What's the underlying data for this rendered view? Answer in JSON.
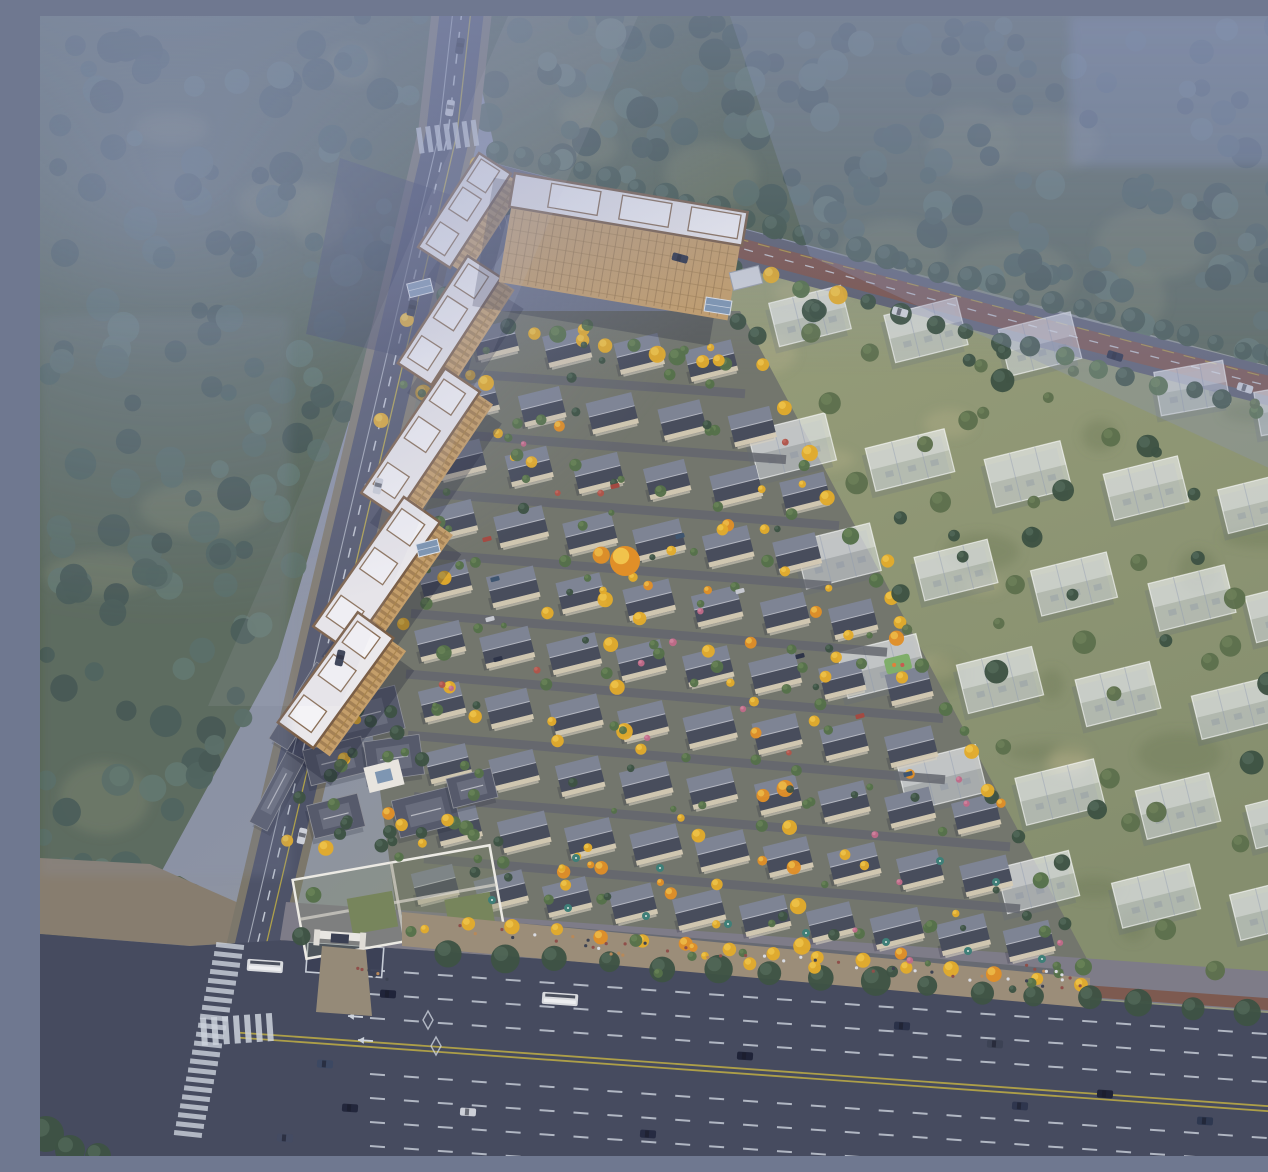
{
  "scene": {
    "type": "aerial-architectural-rendering",
    "description": "Aerial bird's-eye rendering of a residential masterplan: tan high-rise towers along a diagonal road on the left, rows of gray-roofed courtyard townhouses with yellow autumn trees in the center, translucent future-phase villa massings on olive grass to the right, forest with blue haze above, a Chinese-style clubhouse and walled entrance garden, and a wide multi-lane city road across the bottom with buses and cars."
  },
  "palette": {
    "base_stops": [
      "#7e88a3",
      "#8d93a2",
      "#989d85",
      "#8e937c"
    ],
    "forest": [
      "#3a4d43",
      "#455b4f",
      "#51675a",
      "#3e5248",
      "#5b7162"
    ],
    "forest_clearing": "#75805f",
    "grass1": "#9aa07c",
    "grass2": "#858e6e",
    "mottle_dark": "#6e7a57",
    "mottle_light": "#b8b28b",
    "town_ground": "#73766d",
    "town_street": "#64676f",
    "road_fill": "#4e5368",
    "roadC_fill": "#464b5f",
    "road_casing": "#7c776b",
    "roadB_red": "#7e544a",
    "roadB_casing": "#5d6070",
    "lane_white": "#ccd2dc",
    "lane_yellow": "#bfae45",
    "sidewalk_tan": "#877d6f",
    "sidewalk_gray": "#7e7c88",
    "path_red": "#7d574a",
    "plaza_shadow": "#39405c",
    "tower_roof": "#eae8eb",
    "tower_block": "#f4f3f6",
    "tower_trim": "#7a5e46",
    "tower_facade": "#c49e6a",
    "tower_facade_line": "#8a6a44",
    "tower_shadow": "rgba(24,29,52,0.28)",
    "house_roof_light": "#7e8494",
    "house_roof_dark": "#484d5c",
    "house_ridge": "#b4b7c1",
    "house_wall": "#d6cbb5",
    "house_wall2": "#d8d2c2",
    "ghost_fill": "rgba(239,243,250,0.44)",
    "ghost_stroke": "rgba(255,255,255,0.6)",
    "ghost_line": "rgba(140,150,175,0.4)",
    "ghost_roof": "rgba(255,255,255,0.3)",
    "ghost_shadow": "rgba(90,100,125,0.18)",
    "club_roof": "#565a6b",
    "club_roof_in": "#696d7d",
    "club_ridge": "#b6b8c0",
    "club_court": "#e8e5df",
    "club_glass": "#7e96b2",
    "garden_wall": "#eceae4",
    "garden_fill": "rgba(125,135,105,0.3)",
    "lawn": "#77855c",
    "tree_yellow": "#e2ab2c",
    "tree_yellow_hl": "#f5cf55",
    "tree_orange": "#e08f28",
    "tree_green": "#55704a",
    "tree_green_hl": "#6f8a5c",
    "tree_dark": "#3d5244",
    "tree_dark_hl": "#58705f",
    "flower_pink": "#c06a88",
    "flower_red": "#b0544a",
    "umbrella": "#3f7f78",
    "boulevard": "#9b8d79",
    "entrance_path": "#958a78",
    "people": [
      "#d9dbe2",
      "#3c4252",
      "#b8895a",
      "#8f4f4a"
    ],
    "bus": "#d8dade",
    "glass_canopy": "#7e96b2",
    "haze": "#8a95ba",
    "haze2": "#8e9ac6",
    "beam": "#c2c8da",
    "playground": "#7fae6a"
  },
  "regions": {
    "forest_tl": [
      [
        0,
        0
      ],
      [
        418,
        0
      ],
      [
        394,
        128
      ],
      [
        302,
        428
      ],
      [
        238,
        642
      ],
      [
        118,
        862
      ],
      [
        0,
        902
      ]
    ],
    "forest_top": [
      [
        426,
        0
      ],
      [
        1268,
        0
      ],
      [
        1268,
        360
      ],
      [
        458,
        148
      ]
    ],
    "forest_left_low": [
      [
        0,
        860
      ],
      [
        140,
        860
      ],
      [
        200,
        895
      ],
      [
        0,
        930
      ]
    ],
    "grass": [
      [
        450,
        168
      ],
      [
        1268,
        396
      ],
      [
        1268,
        988
      ],
      [
        1052,
        960
      ],
      [
        695,
        300
      ],
      [
        556,
        236
      ]
    ],
    "town": [
      [
        385,
        295
      ],
      [
        700,
        295
      ],
      [
        1055,
        958
      ],
      [
        1050,
        992
      ],
      [
        362,
        938
      ],
      [
        330,
        700
      ],
      [
        345,
        420
      ]
    ],
    "sidewalk_curve": [
      [
        0,
        842
      ],
      [
        110,
        848
      ],
      [
        210,
        892
      ],
      [
        246,
        924
      ],
      [
        150,
        930
      ],
      [
        0,
        918
      ]
    ],
    "roadC": [
      [
        0,
        918
      ],
      [
        150,
        930
      ],
      [
        246,
        924
      ],
      [
        1268,
        1000
      ],
      [
        1268,
        1140
      ],
      [
        0,
        1140
      ]
    ],
    "sidewalkC": [
      [
        246,
        886
      ],
      [
        1268,
        958
      ],
      [
        1268,
        998
      ],
      [
        240,
        924
      ]
    ],
    "redpathC": [
      [
        430,
        925
      ],
      [
        1268,
        985
      ],
      [
        1268,
        997
      ],
      [
        428,
        936
      ]
    ],
    "intersection_shadow": [
      [
        300,
        142
      ],
      [
        468,
        198
      ],
      [
        428,
        356
      ],
      [
        266,
        318
      ]
    ],
    "boulevard": [
      [
        362,
        896
      ],
      [
        1050,
        962
      ],
      [
        1050,
        992
      ],
      [
        362,
        930
      ]
    ],
    "tower_green": [
      [
        360,
        250
      ],
      [
        470,
        280
      ],
      [
        420,
        700
      ],
      [
        300,
        720
      ]
    ],
    "club_green": [
      [
        245,
        672
      ],
      [
        468,
        672
      ],
      [
        468,
        848
      ],
      [
        245,
        848
      ]
    ],
    "entrance_path": [
      [
        282,
        930
      ],
      [
        326,
        934
      ],
      [
        332,
        1000
      ],
      [
        276,
        996
      ]
    ]
  },
  "roads": {
    "a_path": "M422,-6 L408,118 L215,938 L236,1146",
    "a_yellow": "M431,-6 L417,118 L224,938",
    "a_edge": "M413,-6 L399,118 L206,936",
    "a_casing_w": 60,
    "a_w": 44,
    "b_path": "M420,158 L700,232 L1000,312 L1268,380",
    "b_casing_w": 38,
    "b_w": 30,
    "b_red_w": 20,
    "c_top": [
      246,
      924,
      1268,
      997
    ],
    "c_dash_offsets": [
      24,
      48,
      72,
      128,
      152,
      176,
      200
    ],
    "c_yellow_offsets": [
      96,
      101
    ],
    "c_dash_start_x": 330,
    "arrows": [
      [
        288,
        952
      ],
      [
        298,
        976
      ],
      [
        308,
        1000
      ],
      [
        318,
        1024
      ]
    ],
    "diamonds": [
      [
        388,
        1004
      ],
      [
        396,
        1030
      ]
    ],
    "gate_plaza": {
      "x": 268,
      "y": 926,
      "w": 76,
      "h": 30,
      "rot": 4.2
    },
    "zebraC": {
      "x1": 190,
      "y1": 930,
      "x2": 148,
      "y2": 1118,
      "n": 22,
      "bar_w": 28,
      "bar_h": 5,
      "rot": 6
    },
    "zebraA_top": {
      "tx": 376,
      "ty": 112,
      "rot": -8,
      "n": 7,
      "step": 9.2,
      "bw": 5,
      "bh": 26
    },
    "zebraB": {
      "tx": 446,
      "ty": 160,
      "rot": 16,
      "n": 6,
      "step": 8,
      "bw": 4.5,
      "bh": 24
    },
    "zebraA_bot": {
      "tx": 160,
      "ty": 1002,
      "rot": -4,
      "n": 7,
      "step": 11,
      "bw": 6,
      "bh": 28
    },
    "stalls": {
      "x": 448,
      "y": 196,
      "n": 6,
      "step": 8,
      "len": 18,
      "rot": 75
    }
  },
  "towers": [
    [
      427,
      196,
      112,
      44,
      -57
    ],
    [
      412,
      306,
      128,
      46,
      -57
    ],
    [
      383,
      428,
      150,
      48,
      -56
    ],
    [
      339,
      560,
      158,
      50,
      -55
    ],
    [
      298,
      666,
      136,
      50,
      -54
    ]
  ],
  "complex": {
    "cx": 583,
    "cy": 226,
    "rot": 9.5,
    "len": 232,
    "roof_h": 34,
    "fac_h": 76
  },
  "canopies": [
    [
      380,
      272,
      24,
      14,
      -14
    ],
    [
      388,
      532,
      22,
      13,
      -14
    ],
    [
      678,
      290,
      26,
      14,
      9
    ]
  ],
  "utility": {
    "x": 706,
    "y": 262,
    "w": 30,
    "h": 18,
    "rot": -14
  },
  "townhouses": {
    "angle": -14,
    "slope": 0.095,
    "rows": [
      [
        318,
        455,
        4,
        72
      ],
      [
        380,
        432,
        5,
        70
      ],
      [
        441,
        420,
        6,
        69
      ],
      [
        502,
        412,
        6,
        69
      ],
      [
        563,
        405,
        7,
        68
      ],
      [
        624,
        400,
        8,
        67
      ],
      [
        685,
        402,
        8,
        67
      ],
      [
        746,
        408,
        9,
        66
      ],
      [
        807,
        418,
        9,
        66
      ],
      [
        868,
        395,
        10,
        66
      ]
    ]
  },
  "playground": {
    "x": 858,
    "y": 648,
    "w": 26,
    "h": 16,
    "rot": -14
  },
  "ghosts": {
    "angle": -14,
    "w": 82,
    "h": 50,
    "items": [
      [
        770,
        300
      ],
      [
        886,
        314
      ],
      [
        1000,
        328
      ],
      [
        752,
        430
      ],
      [
        870,
        444
      ],
      [
        988,
        458
      ],
      [
        1106,
        472
      ],
      [
        1222,
        486
      ],
      [
        798,
        540
      ],
      [
        916,
        554
      ],
      [
        1034,
        568
      ],
      [
        1152,
        582
      ],
      [
        1250,
        594
      ],
      [
        842,
        650
      ],
      [
        960,
        664
      ],
      [
        1078,
        678
      ],
      [
        1196,
        692
      ],
      [
        902,
        762
      ],
      [
        1020,
        776
      ],
      [
        1138,
        790
      ],
      [
        1248,
        802
      ],
      [
        998,
        866
      ],
      [
        1116,
        880
      ],
      [
        1234,
        892
      ]
    ],
    "corner": [
      [
        1152,
        372
      ],
      [
        1252,
        392
      ]
    ]
  },
  "clubhouse": {
    "roofs": [
      [
        322,
        700,
        78,
        44,
        -14
      ],
      [
        296,
        745,
        60,
        36,
        -14
      ],
      [
        354,
        742,
        56,
        40,
        -8
      ],
      [
        386,
        796,
        62,
        38,
        -14
      ],
      [
        296,
        800,
        52,
        34,
        -14
      ],
      [
        432,
        772,
        46,
        30,
        -14
      ],
      [
        262,
        690,
        90,
        22,
        -58
      ],
      [
        237,
        775,
        80,
        20,
        -62
      ]
    ],
    "courtyard": {
      "x": 344,
      "y": 760,
      "w": 36,
      "h": 26,
      "rot": -14
    },
    "garden": {
      "x": 358,
      "y": 886,
      "w": 200,
      "h": 80,
      "rot": -10
    },
    "lawns": [
      [
        308,
        874,
        46,
        36
      ],
      [
        404,
        892,
        46,
        36
      ]
    ],
    "gate": {
      "x": 300,
      "y": 920
    }
  },
  "tree_bands": [
    {
      "x1": 455,
      "y1": 136,
      "x2": 1262,
      "y2": 352,
      "n": 30,
      "rmin": 8,
      "rmax": 13,
      "kind": "dark",
      "jit": 8
    },
    {
      "x1": 470,
      "y1": 190,
      "x2": 1250,
      "y2": 404,
      "n": 25,
      "rmin": 7,
      "rmax": 11,
      "kind": "mix_gd",
      "jit": 8
    },
    {
      "x1": 437,
      "y1": 146,
      "x2": 262,
      "y2": 922,
      "n": 18,
      "rmin": 6,
      "rmax": 10,
      "kind": "mix_gy",
      "jit": 7
    },
    {
      "x1": 697,
      "y1": 308,
      "x2": 1046,
      "y2": 952,
      "n": 16,
      "rmin": 6,
      "rmax": 9,
      "kind": "mix_gy",
      "jit": 6
    },
    {
      "x1": 428,
      "y1": 906,
      "x2": 1042,
      "y2": 968,
      "n": 15,
      "rmin": 6,
      "rmax": 8,
      "kind": "yellow",
      "jit": 4
    },
    {
      "x1": 410,
      "y1": 936,
      "x2": 1260,
      "y2": 998,
      "n": 17,
      "rmin": 10,
      "rmax": 15,
      "kind": "dark",
      "jit": 6
    },
    {
      "x1": 560,
      "y1": 538,
      "x2": 584,
      "y2": 716,
      "n": 5,
      "rmin": 7,
      "rmax": 9,
      "kind": "yellow",
      "jit": 3
    },
    {
      "x1": 744,
      "y1": 772,
      "x2": 762,
      "y2": 930,
      "n": 5,
      "rmin": 7,
      "rmax": 9,
      "kind": "yellow",
      "jit": 3
    },
    {
      "x1": 848,
      "y1": 545,
      "x2": 862,
      "y2": 660,
      "n": 4,
      "rmin": 6,
      "rmax": 8,
      "kind": "yellow",
      "jit": 3
    },
    {
      "x1": 470,
      "y1": 312,
      "x2": 688,
      "y2": 348,
      "n": 10,
      "rmin": 6,
      "rmax": 9,
      "kind": "mix_gy",
      "jit": 6
    }
  ],
  "big_tree": {
    "x": 585,
    "y": 545,
    "r": 15
  },
  "scatters": [
    {
      "region": "forest_tl",
      "n": 150,
      "rmin": 8,
      "rmax": 17,
      "kind": "forest"
    },
    {
      "region": "forest_top",
      "n": 170,
      "rmin": 8,
      "rmax": 16,
      "kind": "forest"
    },
    {
      "region": "forest_left_low",
      "n": 8,
      "rmin": 8,
      "rmax": 14,
      "kind": "forest"
    },
    {
      "region": "tower_green",
      "n": 24,
      "rmin": 4,
      "rmax": 8,
      "kind": "mix_gy"
    },
    {
      "region": "club_green",
      "n": 21,
      "rmin": 5,
      "rmax": 8,
      "kind": "mix_gd"
    },
    {
      "region": "town",
      "n": 70,
      "rmin": 3.5,
      "rmax": 7,
      "kind": "yellow"
    },
    {
      "region": "town",
      "n": 90,
      "rmin": 3,
      "rmax": 6.5,
      "kind": "green"
    },
    {
      "region": "town",
      "n": 30,
      "rmin": 3,
      "rmax": 6,
      "kind": "dark"
    },
    {
      "region": "town",
      "n": 14,
      "rmin": 2.5,
      "rmax": 4,
      "kind": "pink"
    },
    {
      "region": "town",
      "n": 6,
      "rmin": 2.5,
      "rmax": 4,
      "kind": "red"
    },
    {
      "region": "grass",
      "n": 60,
      "rmin": 5,
      "rmax": 12,
      "kind": "grass_tree"
    }
  ],
  "mottles": {
    "dark_n": 40,
    "light_n": 20
  },
  "umbrellas": [
    [
      452,
      884
    ],
    [
      528,
      892
    ],
    [
      606,
      900
    ],
    [
      688,
      908
    ],
    [
      766,
      917
    ],
    [
      846,
      926
    ],
    [
      928,
      935
    ],
    [
      1002,
      943
    ],
    [
      900,
      845
    ],
    [
      956,
      866
    ],
    [
      536,
      842
    ],
    [
      620,
      852
    ]
  ],
  "people_lines": [
    {
      "x1": 420,
      "y1": 914,
      "x2": 1040,
      "y2": 972,
      "n": 34,
      "jit": 9
    },
    {
      "x1": 990,
      "y1": 952,
      "x2": 1030,
      "y2": 964,
      "n": 8,
      "jit": 7
    },
    {
      "x1": 315,
      "y1": 952,
      "x2": 345,
      "y2": 962,
      "n": 6,
      "jit": 6
    },
    {
      "x1": 545,
      "y1": 930,
      "x2": 585,
      "y2": 940,
      "n": 6,
      "jit": 6
    }
  ],
  "parked_cars": {
    "colors": [
      "#a34a42",
      "#3e5570",
      "#c6c8cf",
      "#2e3448"
    ],
    "items": [
      [
        447,
        523
      ],
      [
        455,
        563
      ],
      [
        450,
        603
      ],
      [
        458,
        643
      ],
      [
        575,
        470
      ],
      [
        640,
        520
      ],
      [
        700,
        575
      ],
      [
        760,
        640
      ],
      [
        820,
        700
      ],
      [
        868,
        758
      ]
    ]
  },
  "vehicles": {
    "buses": [
      [
        225,
        950,
        4
      ],
      [
        520,
        983,
        4
      ]
    ],
    "carsC": [
      [
        348,
        978,
        "#20243a"
      ],
      [
        285,
        1048,
        "#3c4862"
      ],
      [
        310,
        1092,
        "#23273c"
      ],
      [
        428,
        1096,
        "#cdd0d8"
      ],
      [
        705,
        1040,
        "#1f2338"
      ],
      [
        862,
        1010,
        "#2a3148"
      ],
      [
        955,
        1028,
        "#3c4254"
      ],
      [
        1065,
        1078,
        "#1f2336"
      ],
      [
        1165,
        1105,
        "#2e3850"
      ],
      [
        608,
        1118,
        "#262b42"
      ],
      [
        980,
        1090,
        "#2f364e"
      ],
      [
        245,
        1122,
        "#444b62"
      ]
    ],
    "carsA": [
      [
        420,
        30,
        99,
        "#2d3244"
      ],
      [
        410,
        92,
        99,
        "#cfd2da"
      ],
      [
        372,
        292,
        103,
        "#2d3244"
      ],
      [
        338,
        470,
        103,
        "#cdd0d8"
      ],
      [
        300,
        642,
        103,
        "#343b50"
      ],
      [
        262,
        820,
        103,
        "#cdd0d8"
      ]
    ],
    "carsB": [
      [
        640,
        242,
        15,
        "#2d3346"
      ],
      [
        860,
        296,
        16,
        "#cdd0d8"
      ],
      [
        1075,
        340,
        17,
        "#242a40"
      ],
      [
        1205,
        372,
        17,
        "#cdd0d8"
      ]
    ]
  },
  "corner_trees": [
    [
      6,
      1118,
      18
    ],
    [
      30,
      1134,
      15
    ],
    [
      58,
      1140,
      13
    ]
  ],
  "haze": {
    "tr_poly": [
      [
        690,
        0
      ],
      [
        1268,
        0
      ],
      [
        1268,
        470
      ],
      [
        770,
        240
      ]
    ],
    "beam_poly": [
      [
        468,
        0
      ],
      [
        598,
        0
      ],
      [
        300,
        690
      ],
      [
        168,
        690
      ]
    ]
  }
}
